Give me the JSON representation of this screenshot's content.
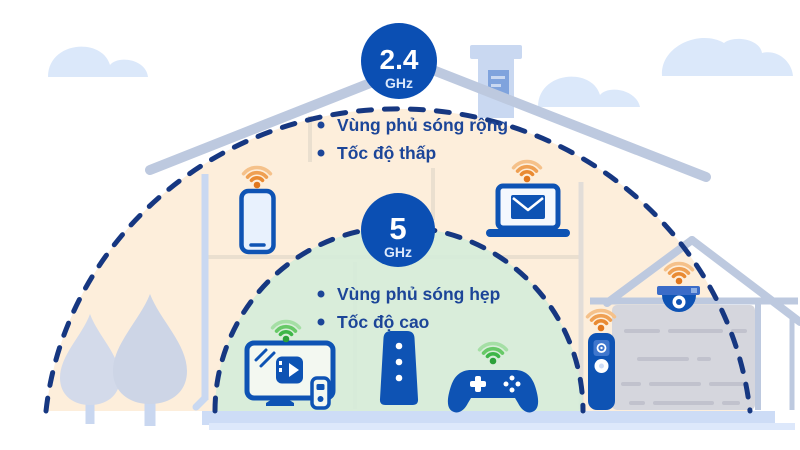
{
  "infographic": {
    "band_24ghz": {
      "badge_value": "2.4",
      "badge_unit": "GHz",
      "bullets": [
        "Vùng phủ sóng rộng",
        "Tốc độ thấp"
      ]
    },
    "band_5ghz": {
      "badge_value": "5",
      "badge_unit": "GHz",
      "bullets": [
        "Vùng phủ sóng hẹp",
        "Tốc độ cao"
      ]
    },
    "colors": {
      "badge_blue": "#0b4fb3",
      "text_navy": "#1c4598",
      "dash_navy": "#163781",
      "band_24ghz_fill": "#fdeedb",
      "band_5ghz_fill": "#d5ecd9",
      "device_blue": "#0e53b4",
      "structure_gray_blue": "#bdc9df",
      "wifi_orange": [
        "#f5c18a",
        "#efa053",
        "#e98a32",
        "#e1771d"
      ],
      "wifi_green": [
        "#a5dfa5",
        "#67c967",
        "#3eb648",
        "#2ca13a"
      ]
    }
  }
}
